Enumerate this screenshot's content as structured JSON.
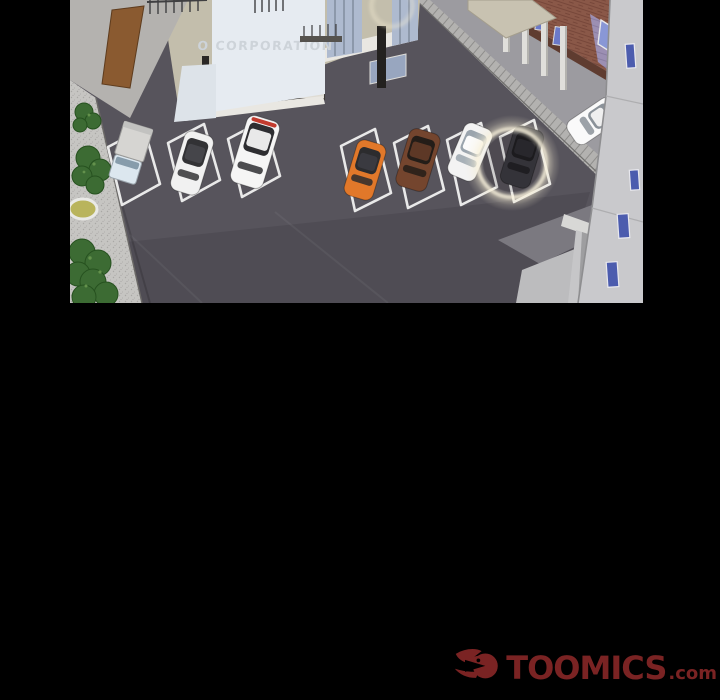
{
  "page": {
    "background_color": "#000000"
  },
  "comic": {
    "panel": {
      "building_sign": "O CORPORATION",
      "description": "Isometric aerial view of an office-building parking lot; the dark car in the right-most space is circled with a glowing spotlight ring.",
      "highlight_color": "#f6eed4",
      "asphalt_color": "#57545c",
      "road_color": "#9c9ba0",
      "sidewalk_color": "#c6c5c2"
    },
    "cars": [
      {
        "name": "box-truck",
        "kind": "truck",
        "x": 60,
        "y": 154,
        "rot": 17,
        "body": "#dce7ef",
        "cargo": "#d6d5d2",
        "glass": "#879cab"
      },
      {
        "name": "white-sedan",
        "kind": "car",
        "x": 122,
        "y": 163,
        "rot": 17,
        "len": 62,
        "wid": 30,
        "body": "#f1f1f1",
        "glass": "#323235",
        "roof": "#45454a"
      },
      {
        "name": "white-suv",
        "kind": "car",
        "x": 185,
        "y": 152,
        "rot": 17,
        "len": 70,
        "wid": 34,
        "body": "#f5f5f5",
        "glass": "#2e2e31",
        "roof": "#e9e9e9",
        "accent": "#c23b2e"
      },
      {
        "name": "orange-hatchback",
        "kind": "car",
        "x": 295,
        "y": 170,
        "rot": 17,
        "len": 58,
        "wid": 30,
        "body": "#e1782a",
        "glass": "#2c2c2e",
        "roof": "#3a3a40"
      },
      {
        "name": "brown-suv",
        "kind": "car",
        "x": 348,
        "y": 160,
        "rot": 17,
        "len": 60,
        "wid": 32,
        "body": "#74452e",
        "glass": "#241d18",
        "roof": "#5d3826"
      },
      {
        "name": "white-compact",
        "kind": "car",
        "x": 400,
        "y": 152,
        "rot": 23,
        "len": 56,
        "wid": 30,
        "body": "#f3f3f3",
        "glass": "#9aa4ad",
        "roof": "#fbfbfb"
      },
      {
        "name": "dark-car-highlighted",
        "kind": "car",
        "x": 452,
        "y": 157,
        "rot": 17,
        "len": 60,
        "wid": 31,
        "body": "#3a3a40",
        "glass": "#1e1e22",
        "roof": "#2c2c31"
      },
      {
        "name": "white-minivan",
        "kind": "car",
        "x": 524,
        "y": 121,
        "rot": 56,
        "len": 54,
        "wid": 28,
        "body": "#fafafa",
        "glass": "#8b9299",
        "roof": "#efefef"
      }
    ]
  },
  "watermark": {
    "brand": "TOOMICS",
    "suffix": ".com",
    "color": "#7a2323",
    "icon": "toomics-wing-logo"
  }
}
